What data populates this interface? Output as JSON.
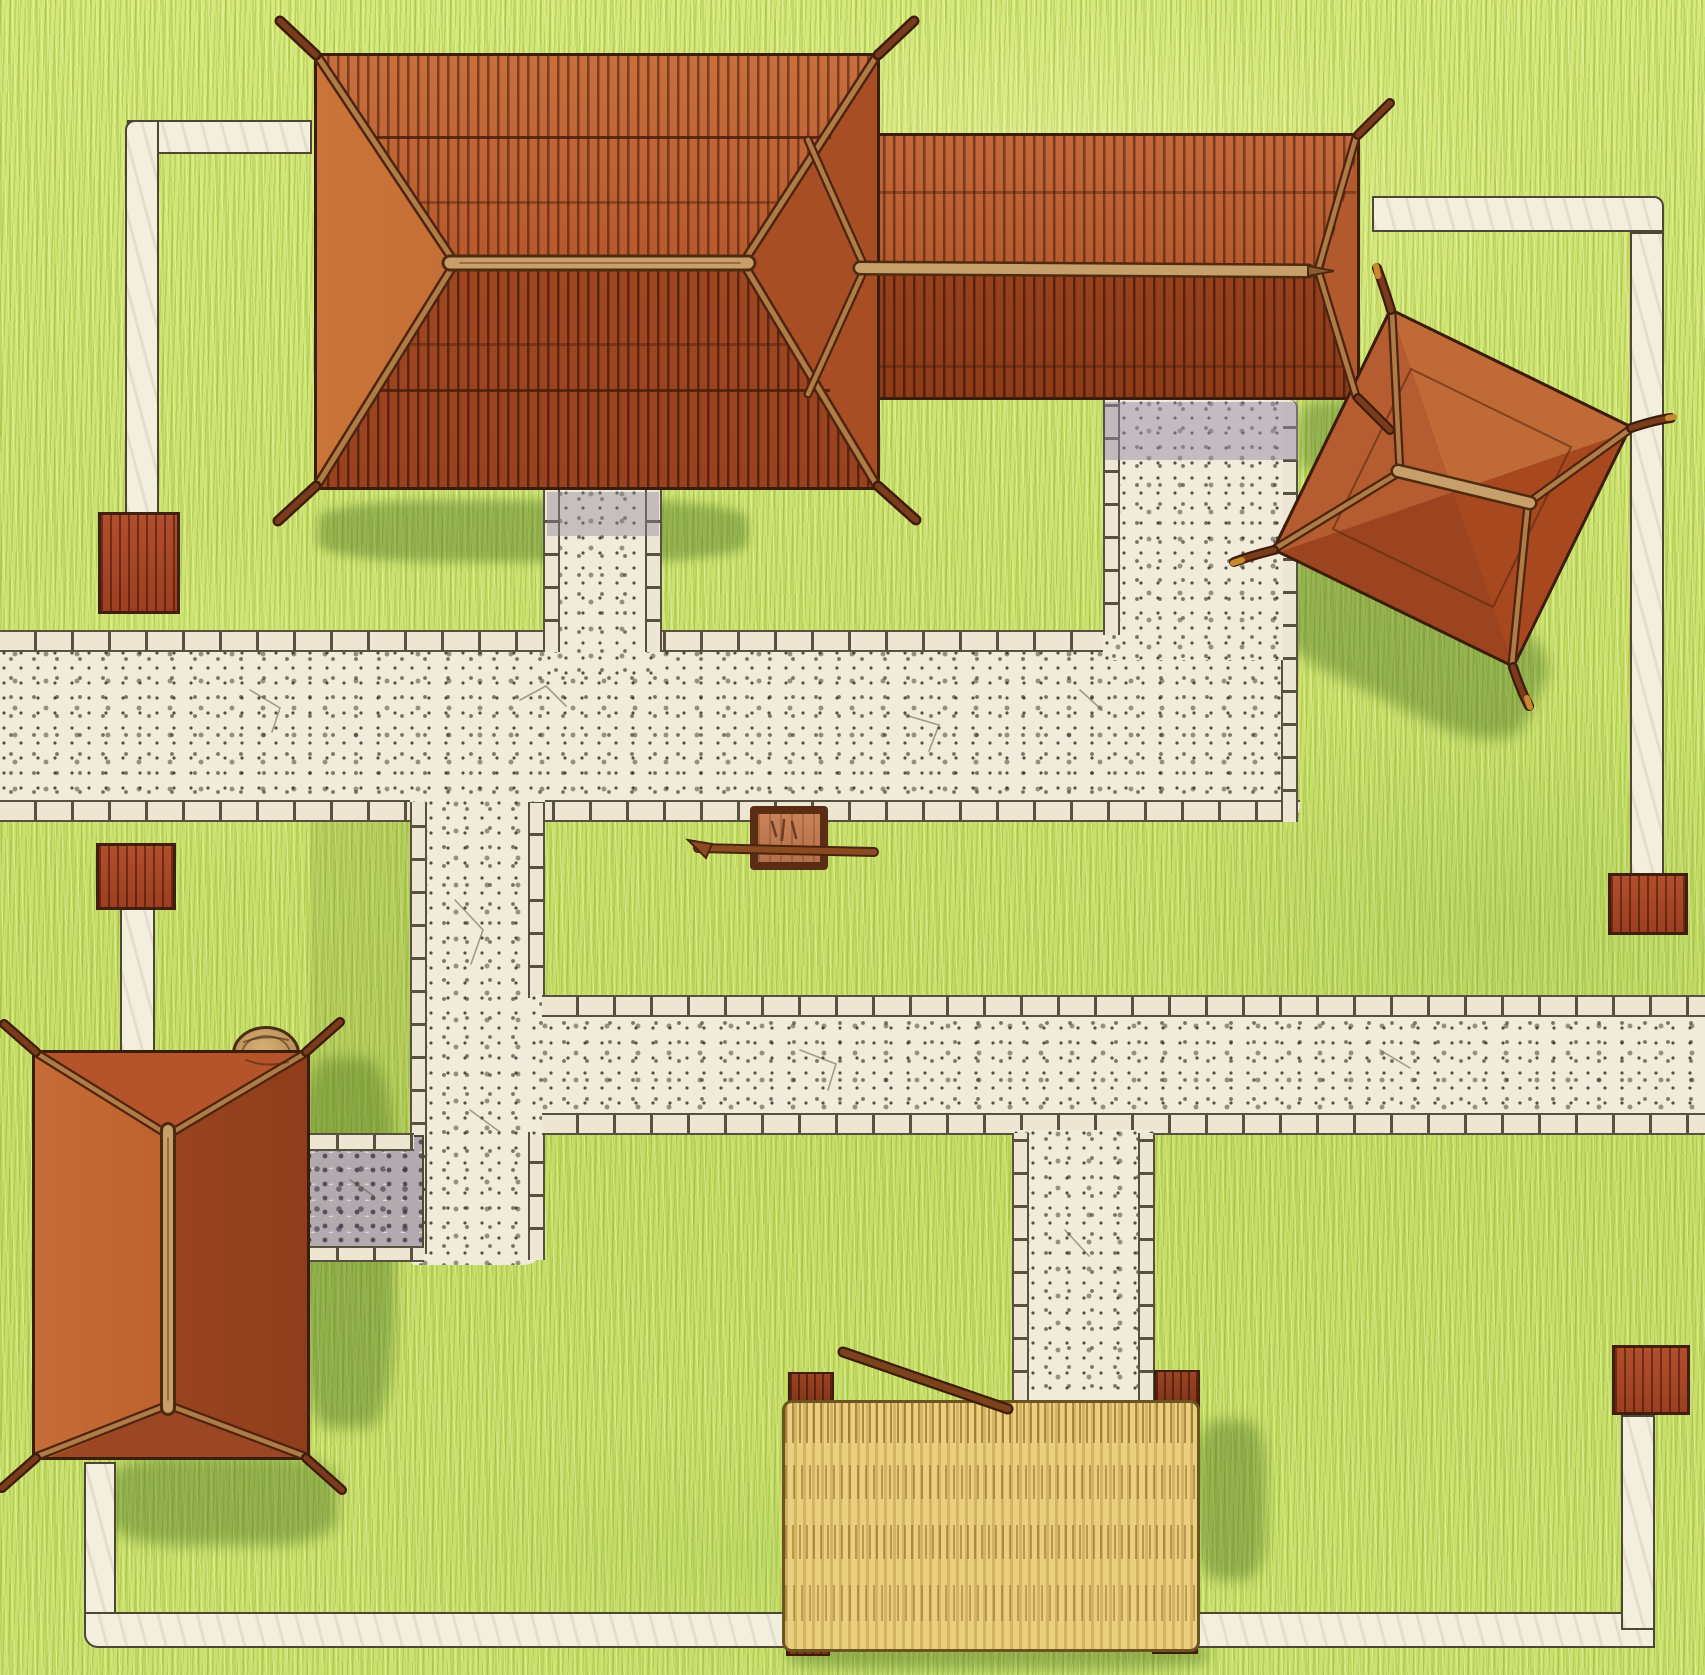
{
  "scene": {
    "description": "Hand-drawn top-down map of a small village: large shingled hip-roof house with attached wing, a rotated square hut, a small rectangular house, stone footpaths through yellow-green grass, a hay bale with corner posts, wooden fence posts, a barrel and a small crate with a rod",
    "view": "top-down",
    "art_style": "colored ink and watercolor sketch",
    "visible_text": ""
  },
  "palette": {
    "grass": "#cbe06a",
    "grass-hi": "#e2f08f",
    "grass-dk": "#8fae3c",
    "shadow": "#4e7a28",
    "stone": "#f0ebdb",
    "stone-edge": "#59513f",
    "plain": "#f3efdf",
    "cobble": "#b3aaaf",
    "roof": "#a84d24",
    "roof-hi": "#c4683a",
    "roof-dk": "#8a3a1c",
    "seam": "#3a1d0a",
    "beam": "#c79f6b",
    "pole": "#5e2c12",
    "post": "#a8472a",
    "hay": "#eacf7f",
    "hay-dk": "#7a5414",
    "barrel": "#c9a06a",
    "crate": "#c27c54",
    "crate-frame": "#5a2d14"
  },
  "objects": {
    "buildings": [
      {
        "id": "large-house",
        "shape": "large rectangular hip roof",
        "roof": "red-brown wood shingles",
        "features": [
          "horizontal ridge beam",
          "four hip rafters",
          "corner poles",
          "shingle row lines"
        ]
      },
      {
        "id": "attached-house",
        "shape": "rectangular hip roof attached at right",
        "roof": "red-brown wood shingles",
        "features": [
          "horizontal ridge beam with pointed tip",
          "hip rafters",
          "corner poles"
        ]
      },
      {
        "id": "rotated-hut",
        "shape": "square hip roof rotated about 26 degrees",
        "roof": "red-brown wood shingles",
        "features": [
          "short ridge beam",
          "four hip rafters",
          "curved corner poles"
        ]
      },
      {
        "id": "small-house",
        "shape": "vertical rectangular hip roof",
        "roof": "red-brown wood shingles",
        "features": [
          "vertical ridge beam",
          "hip rafters",
          "corner poles",
          "barrel at top-right corner"
        ]
      }
    ],
    "paths": {
      "stone_paths": "wide speckled cream stone walkways edged with small cobble bricks, running horizontally across the map with branches to each building and to the hay bale",
      "plain_paths": "narrow pale footpaths / fence lines with red-brown wooden posts at their corners",
      "cobble_patch": "small gray cobblestone yard beside the small house"
    },
    "props": [
      {
        "id": "hay-bale",
        "color": "straw yellow",
        "features": [
          "four dark wooden corner posts",
          "stick resting on top"
        ]
      },
      {
        "id": "crate",
        "features": [
          "dark wooden frame",
          "rod passing through"
        ],
        "location": "south edge of main path"
      },
      {
        "id": "barrel",
        "location": "top-right corner of small house"
      },
      {
        "id": "fence-posts",
        "count": 4
      }
    ],
    "ground": "yellow-green grass drawn with fine vertical pencil strokes, darker green shading beside buildings and the hay bale"
  }
}
